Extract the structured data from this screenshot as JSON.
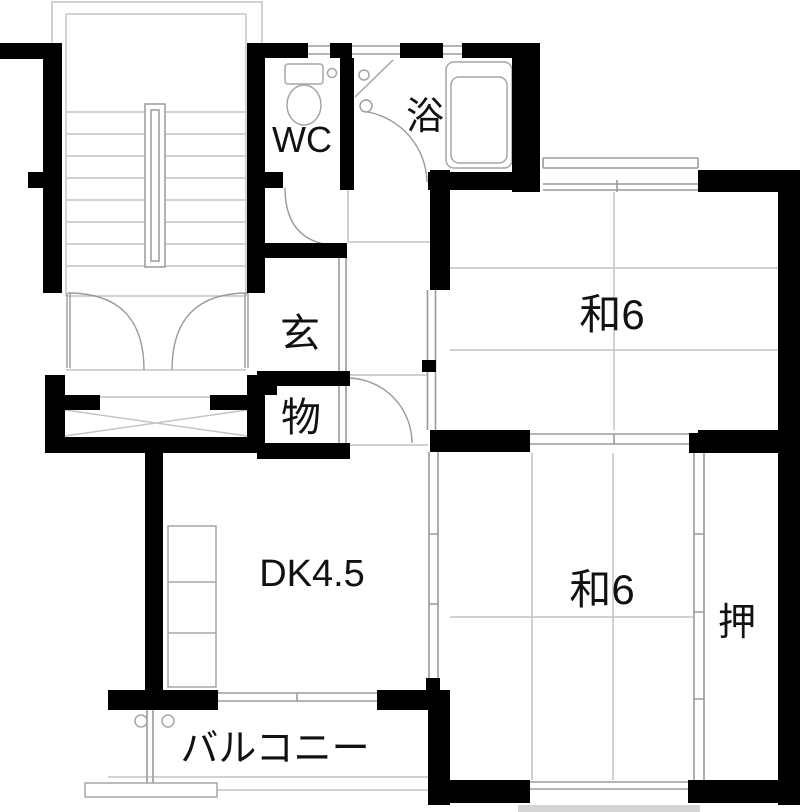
{
  "plan": {
    "rooms": {
      "wc": {
        "label": "WC"
      },
      "bath": {
        "label": "浴"
      },
      "entrance": {
        "label": "玄"
      },
      "storage": {
        "label": "物"
      },
      "tatami_upper": {
        "label": "和6"
      },
      "tatami_lower": {
        "label": "和6"
      },
      "dining_kitchen": {
        "label": "DK4.5"
      },
      "closet": {
        "label": "押"
      },
      "balcony": {
        "label": "バルコニー"
      }
    },
    "colors": {
      "wall": "#000000",
      "line_light": "#c4c4c4",
      "line_mid": "#9a9a9a",
      "fixture": "#a6a6a6",
      "slab": "#d4d4d4",
      "text": "#111111",
      "background": "#ffffff"
    }
  }
}
